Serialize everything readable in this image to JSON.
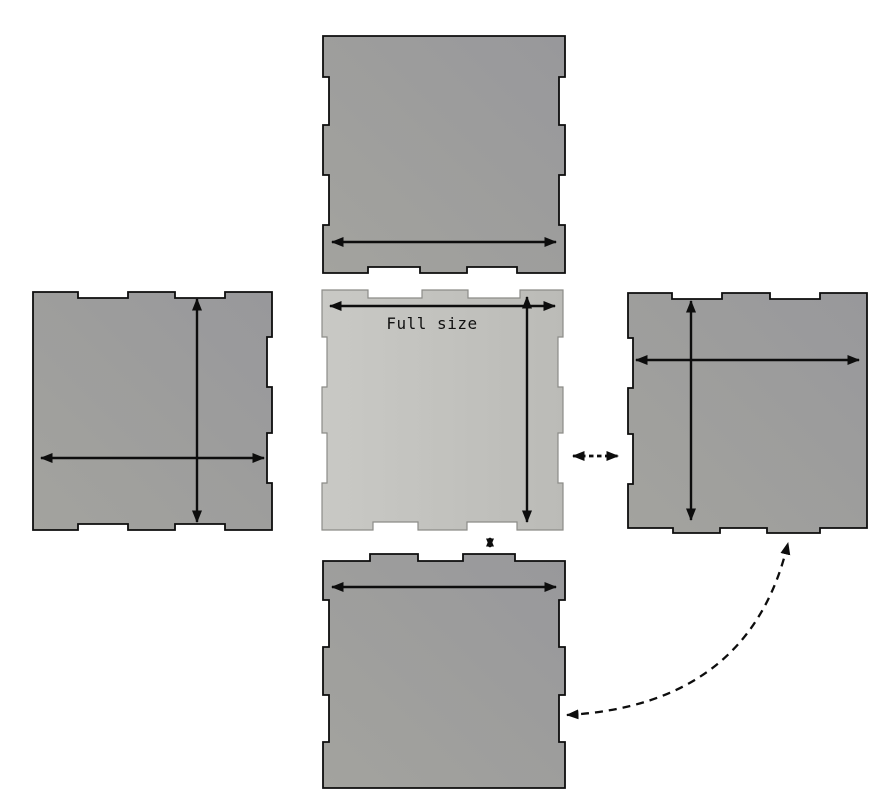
{
  "diagram": {
    "center_label": "Full size"
  },
  "colors": {
    "background": "#ffffff",
    "side_panel_fill": "#98989b",
    "side_panel_fill_light": "#a3a39e",
    "side_panel_stroke": "#0d0d0d",
    "center_panel_fill": "#c9c9c5",
    "center_panel_fill_shade": "#bbbbb7",
    "center_panel_stroke": "#8c8c88",
    "arrow_color": "#0d0d0d",
    "label_color": "#111111"
  }
}
